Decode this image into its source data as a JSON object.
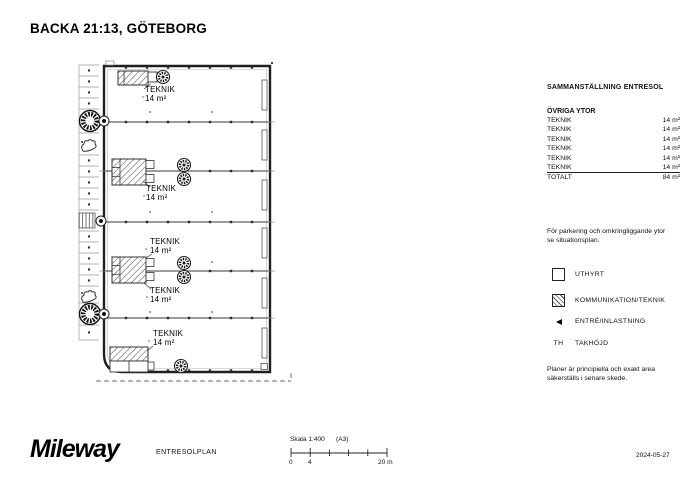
{
  "title": "BACKA 21:13, GÖTEBORG",
  "plan": {
    "room_labels": [
      {
        "name": "TEKNIK",
        "area": "14 m²"
      },
      {
        "name": "TEKNIK",
        "area": "14 m²"
      },
      {
        "name": "TEKNIK",
        "area": "14 m²"
      },
      {
        "name": "TEKNIK",
        "area": "14 m²"
      },
      {
        "name": "TEKNIK",
        "area": "14 m²"
      }
    ]
  },
  "summary": {
    "title": "SAMMANSTÄLLNING ENTRESOL",
    "section": "ÖVRIGA YTOR",
    "rows": [
      {
        "label": "TEKNIK",
        "value": "14 m²"
      },
      {
        "label": "TEKNIK",
        "value": "14 m²"
      },
      {
        "label": "TEKNIK",
        "value": "14 m²"
      },
      {
        "label": "TEKNIK",
        "value": "14 m²"
      },
      {
        "label": "TEKNIK",
        "value": "14 m²"
      },
      {
        "label": "TEKNIK",
        "value": "14 m²"
      }
    ],
    "total": {
      "label": "TOTALT",
      "value": "84 m²"
    }
  },
  "notes": {
    "parking": "För parkering och omkringliggande ytor se situationsplan.",
    "disclaimer": "Planer är principiella och exakt area säkerställs i senare skede."
  },
  "legend": {
    "items": [
      {
        "icon": "uthyrt-swatch",
        "label": "UTHYRT"
      },
      {
        "icon": "hatch-swatch",
        "label": "KOMMUNIKATION/TEKNIK"
      },
      {
        "icon": "entry-arrow",
        "label": "ENTRÉ/INLASTNING"
      },
      {
        "icon": "text-symbol",
        "symbol": "TH",
        "label": "TAKHÖJD"
      }
    ]
  },
  "footer": {
    "logo": "Mileway",
    "drawing_name": "ENTRESOLPLAN",
    "scale_label": "Skala 1:400",
    "paper": "(A3)",
    "scale_ticks": [
      "0",
      "4",
      "20 m"
    ],
    "date": "2024-05-27"
  },
  "colors": {
    "ink": "#111111",
    "wall": "#1f1f1f",
    "grid_gray": "#999999",
    "hatch": "#555555"
  }
}
